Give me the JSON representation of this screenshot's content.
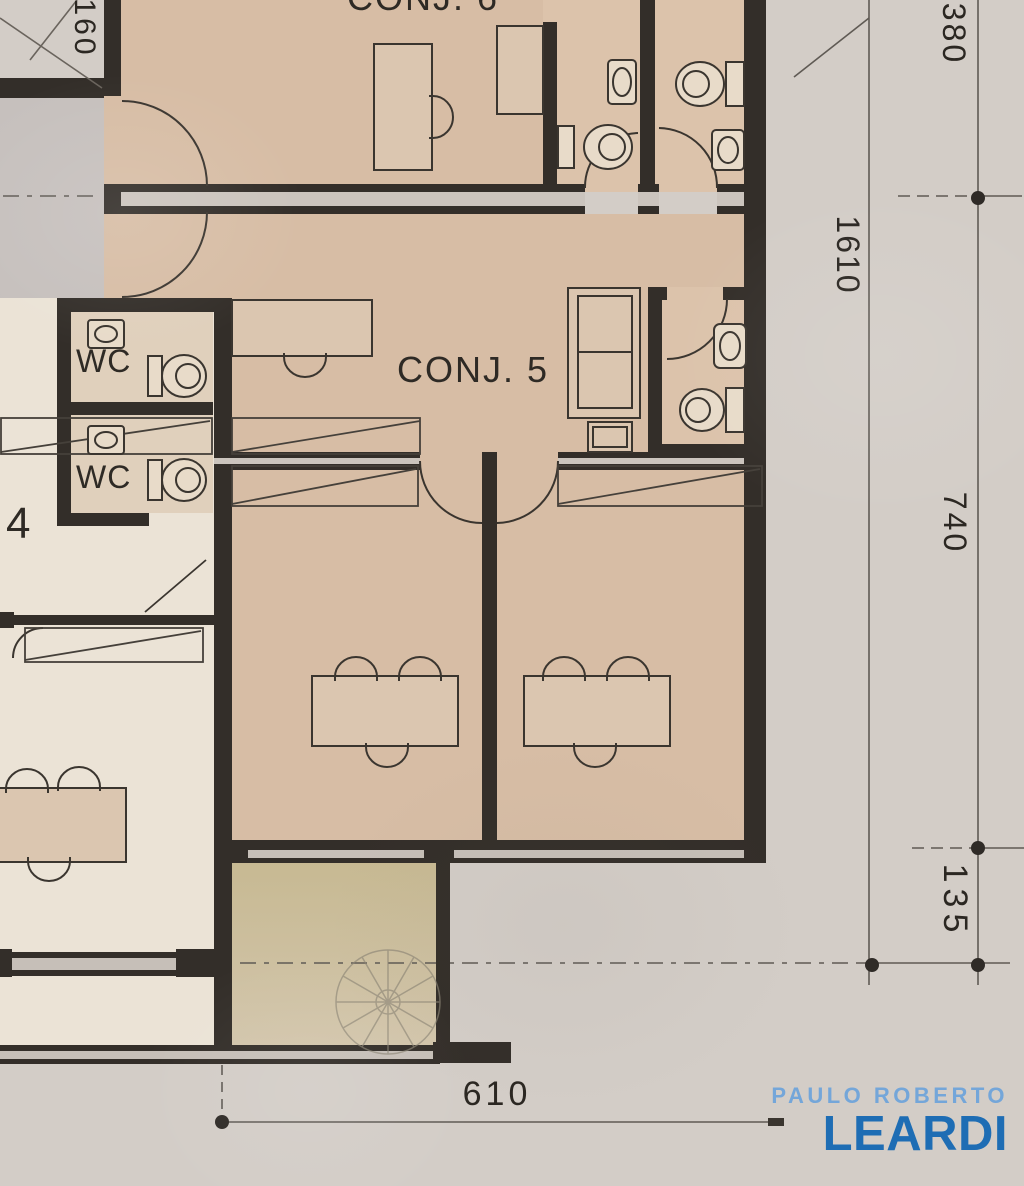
{
  "rooms": {
    "conj6_label": "CONJ. 6",
    "conj5_label": "CONJ. 5",
    "conj4_label": "4",
    "wc_upper_label": "WC",
    "wc_lower_label": "WC"
  },
  "dimensions": {
    "left_top": "160",
    "top_right": "380",
    "right_upper": "1610",
    "right_middle": "740",
    "right_lower": "135",
    "bottom": "610"
  },
  "branding": {
    "line1": "PAULO ROBERTO",
    "line2": "LEARDI",
    "line1_color": "#74a6d9",
    "line2_color": "#1e6db4"
  },
  "palette": {
    "paper": "#d3cdc7",
    "room_tan": "#d7bda5",
    "room_cream": "#ebe3d6",
    "hall_gray": "#c6c0bd",
    "terrace_olive": "#cbbd9a",
    "wall_dark": "#332e29"
  }
}
